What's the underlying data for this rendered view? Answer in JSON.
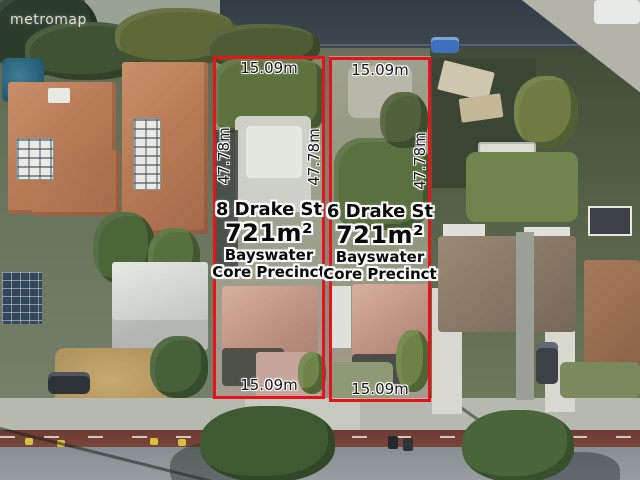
{
  "watermark": {
    "brand": "metromap"
  },
  "colors": {
    "lot_boundary": "#e8121a",
    "label_text": "#0a0a0a",
    "label_halo": "#ffffff"
  },
  "lots": [
    {
      "name": "lot-8-drake-st",
      "address": "8 Drake St",
      "area": "721m²",
      "zone_line1": "Bayswater",
      "zone_line2": "Core Precinct",
      "frontage_top": "15.09m",
      "frontage_bottom": "15.09m",
      "depth_left": "47.78m",
      "depth_right": "47.78m"
    },
    {
      "name": "lot-6-drake-st",
      "address": "6 Drake St",
      "area": "721m²",
      "zone_line1": "Bayswater",
      "zone_line2": "Core Precinct",
      "frontage_top": "15.09m",
      "frontage_bottom": "15.09m",
      "depth_right": "47.78m"
    }
  ]
}
